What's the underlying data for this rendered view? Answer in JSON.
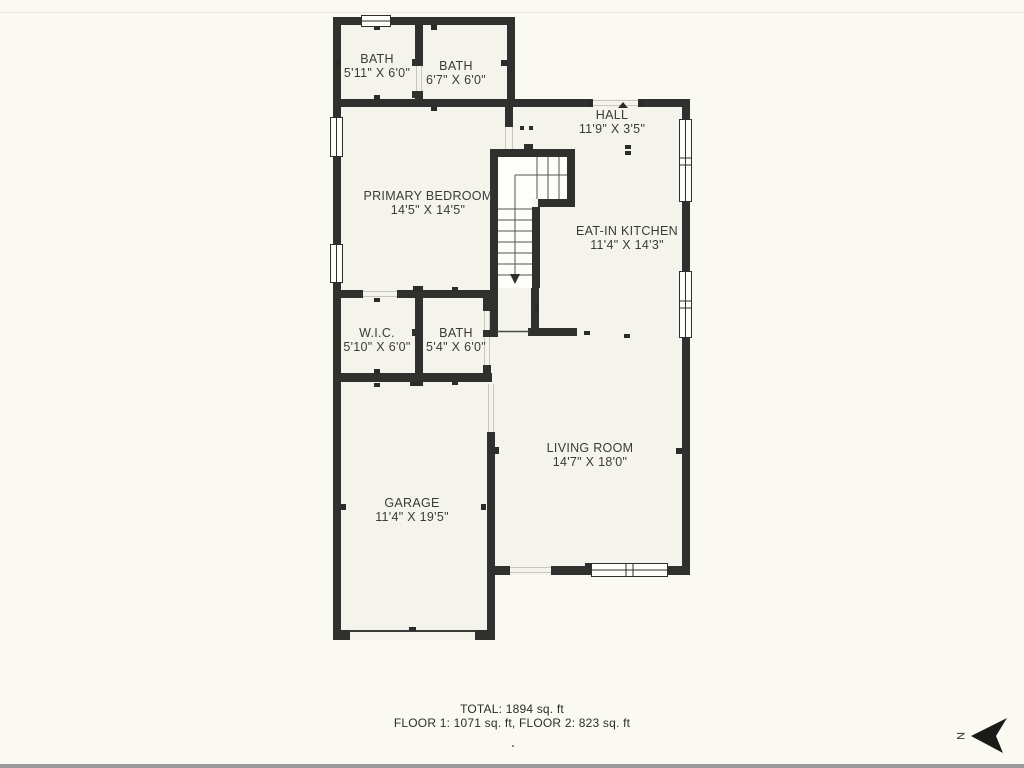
{
  "plan": {
    "rooms": [
      {
        "id": "bath-upper-left",
        "name": "BATH",
        "dims": "5'11\" X 6'0\""
      },
      {
        "id": "bath-upper-right",
        "name": "BATH",
        "dims": "6'7\" X 6'0\""
      },
      {
        "id": "hall",
        "name": "HALL",
        "dims": "11'9\" X 3'5\""
      },
      {
        "id": "primary-bedroom",
        "name": "PRIMARY BEDROOM",
        "dims": "14'5\" X 14'5\""
      },
      {
        "id": "eat-in-kitchen",
        "name": "EAT-IN KITCHEN",
        "dims": "11'4\" X 14'3\""
      },
      {
        "id": "wic",
        "name": "W.I.C.",
        "dims": "5'10\" X 6'0\""
      },
      {
        "id": "bath-middle",
        "name": "BATH",
        "dims": "5'4\" X 6'0\""
      },
      {
        "id": "living-room",
        "name": "LIVING ROOM",
        "dims": "14'7\" X 18'0\""
      },
      {
        "id": "garage",
        "name": "GARAGE",
        "dims": "11'4\" X 19'5\""
      }
    ],
    "summary": {
      "total": "TOTAL: 1894 sq. ft",
      "floors": "FLOOR 1: 1071 sq. ft, FLOOR 2: 823 sq. ft"
    },
    "compass": {
      "label": "N"
    },
    "colors": {
      "wall": "#30302e",
      "room_fill": "#f5f4ec",
      "stair_fill": "#fdfdf9",
      "background": "#fafaf3",
      "text": "#3a3a38",
      "border_bottom": "#9b9b9f"
    }
  }
}
